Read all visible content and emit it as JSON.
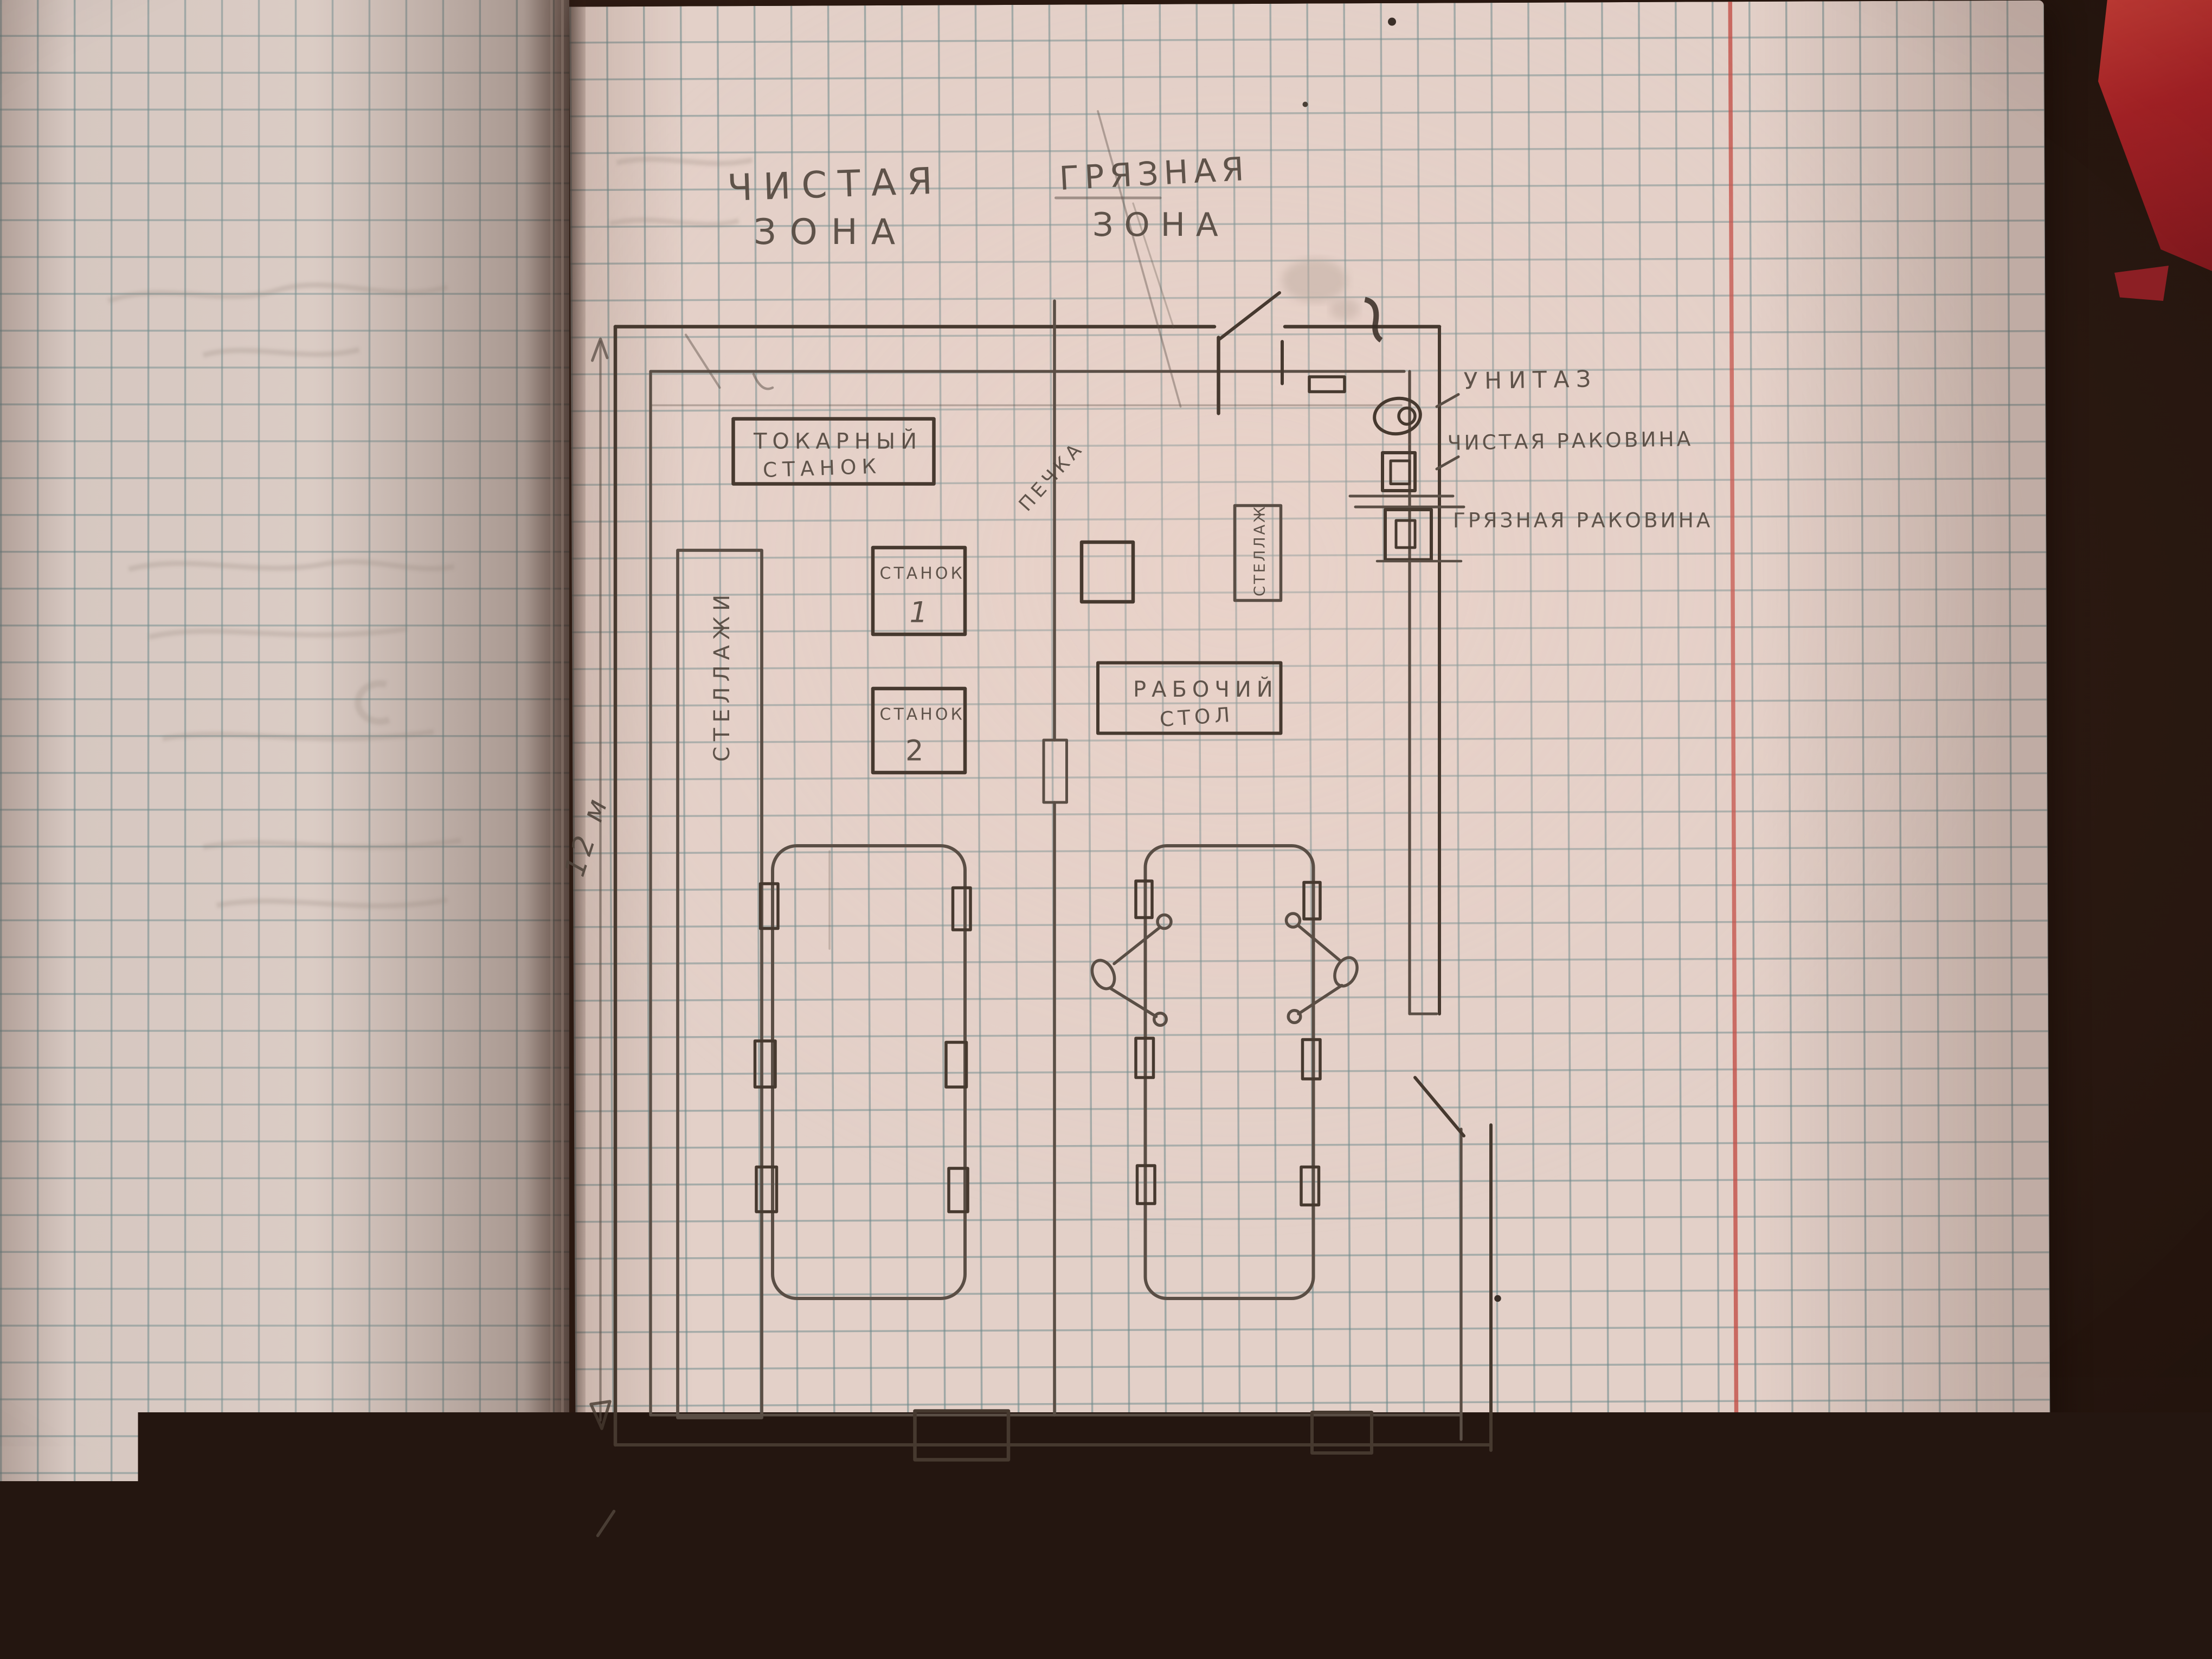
{
  "plan": {
    "zone_clean": {
      "line1": "ЧИСТАЯ",
      "line2": "ЗОНА"
    },
    "zone_dirty": {
      "line1": "ГРЯЗНАЯ",
      "line2": "ЗОНА"
    },
    "lathe": {
      "line1": "ТОКАРНЫЙ",
      "line2": "СТАНОК"
    },
    "machine1": {
      "line1": "СТАНОК",
      "line2": "1"
    },
    "machine2": {
      "line1": "СТАНОК",
      "line2": "2"
    },
    "shelves_left": {
      "label": "СТЕЛЛАЖИ"
    },
    "stove": {
      "label": "ПЕЧКА"
    },
    "shelf_right": {
      "label": "СТЕЛЛАЖ"
    },
    "workbench": {
      "line1": "РАБОЧИЙ",
      "line2": "СТОЛ"
    },
    "toilet": {
      "label": "УНИТАЗ"
    },
    "sink_clean": {
      "label": "ЧИСТАЯ РАКОВИНА"
    },
    "sink_dirty": {
      "label": "ГРЯЗНАЯ РАКОВИНА"
    },
    "dim_height": {
      "label": "12 м"
    },
    "dim_width": {
      "label": "9м"
    }
  },
  "colors": {
    "paper": "#e3d0c8",
    "paper-left": "#d6c7c0",
    "grid": "#68888a",
    "pencil": "#5a4e45",
    "pencil-dark": "#46392f",
    "margin": "#c24b44",
    "table": "#2c1a12",
    "object-red": "#a32125"
  }
}
